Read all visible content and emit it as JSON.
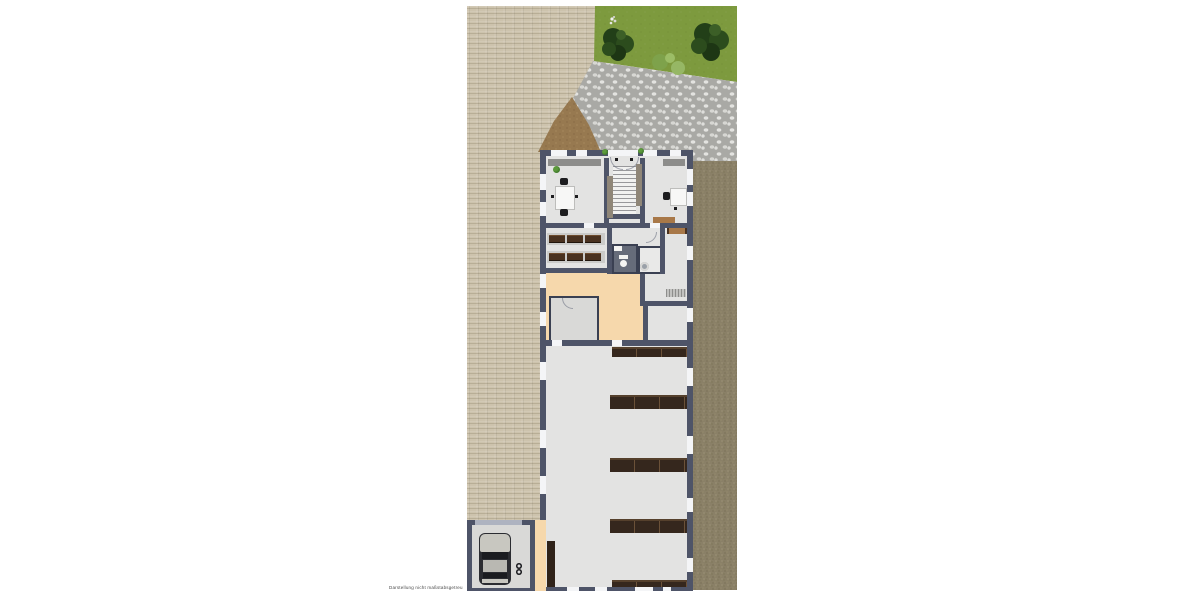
{
  "caption": {
    "text": "Darstellung nicht maßstabsgetreu"
  },
  "colors": {
    "bg": "#ffffff",
    "paving": "#cdc3ad",
    "grass": "#7d9a3e",
    "tree-dark": "#223f18",
    "tree-mid": "#2c4c1d",
    "tree-light": "#3c5f27",
    "bush": "#7ea24b",
    "bush-light": "#96b765",
    "cobble-base": "#a9a9a5",
    "cobble-stone": "#e3e3e0",
    "dirt": "#977950",
    "dirt-dark": "#7a5f3c",
    "gravel": "#8a8067",
    "gravel-dark": "#6d644d",
    "gravel-light": "#a89e83",
    "wall": "#4e5468",
    "wall-dark": "#3a4052",
    "window": "#f4f5f7",
    "floor": "#e3e3e2",
    "floor-dark": "#d9d9d7",
    "peach": "#f6d8ac",
    "bath": "#666c7a",
    "gray-band": "#8d8d8b",
    "stair-strip": "#8f8678",
    "shelf": "#35271d",
    "shelf-line": "#6b5138",
    "bench": "#4a3220",
    "sideboard": "#a87848",
    "desk": "#f7f7f6",
    "chair": "#1d1d1f",
    "car-body": "#2b2c31",
    "car-light": "#c8c7c0",
    "car-glass": "#1b1c20",
    "plant": "#3f7a2a",
    "caption": "#4a4a4a"
  },
  "plan": {
    "regions": [
      {
        "id": "paved-court",
        "material": "brick pavers"
      },
      {
        "id": "lawn",
        "material": "grass",
        "features": [
          "tree",
          "tree",
          "bushes",
          "white-flower-cluster"
        ]
      },
      {
        "id": "cobblestone-path",
        "material": "cobbles"
      },
      {
        "id": "dirt-mound",
        "material": "soil"
      },
      {
        "id": "gravel-strip",
        "material": "gravel"
      }
    ],
    "building": {
      "rooms": [
        {
          "id": "office-left",
          "contents": [
            "wall counter",
            "double desk",
            "chair",
            "chair",
            "plant"
          ]
        },
        {
          "id": "stair-hall",
          "contents": [
            "staircase",
            "entrance doors"
          ]
        },
        {
          "id": "office-right",
          "contents": [
            "wall counter",
            "desk",
            "chair",
            "sideboard"
          ]
        },
        {
          "id": "cloakroom",
          "contents": [
            "bench row",
            "bench row"
          ]
        },
        {
          "id": "wc",
          "contents": [
            "toilet",
            "sink"
          ]
        },
        {
          "id": "washroom",
          "contents": [
            "round basin"
          ]
        },
        {
          "id": "side-room",
          "contents": [
            "bench",
            "radiator"
          ]
        },
        {
          "id": "workshop",
          "floor_color": "peach"
        },
        {
          "id": "storage-hall",
          "contents": [
            "shelf row",
            "shelf row",
            "shelf row",
            "shelf row",
            "shelf row",
            "wall shelf"
          ]
        }
      ]
    },
    "garage": {
      "contents": [
        "car-top-view",
        "figure-eight-marker"
      ]
    }
  }
}
